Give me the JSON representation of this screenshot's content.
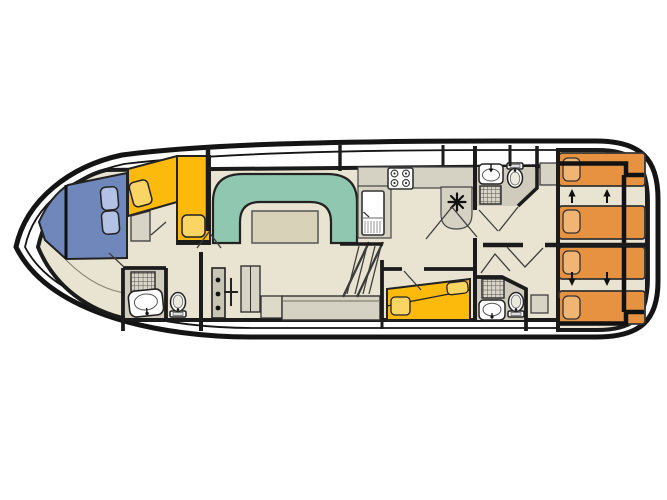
{
  "meta": {
    "type": "boat-deck-plan",
    "description": "Top-down interior floor plan of a canal houseboat, bow pointing left",
    "visible_text": []
  },
  "palette": {
    "hull": "#141414",
    "wall": "#1b1b1b",
    "floor": "#e9e4d2",
    "deck": "#ffffff",
    "bath_floor": "#cfcbbd",
    "counter": "#d5d1c3",
    "furn": "#d7d3c5",
    "sofa_teal": "#90c7b1",
    "table_tan": "#d8d2b8",
    "berth_yellow": "#fbba0c",
    "cushion_yellow": "#fad564",
    "bed_orange": "#e79240",
    "pillow_orange": "#f0b573",
    "bow_blue": "#7087bc",
    "cushion_blue": "#b2c1e4",
    "fixture": "#ffffff",
    "swing": "#3c3c3c",
    "outline": "#333333"
  },
  "rooms": [
    {
      "name": "bow-cabin",
      "furniture": [
        "blue-v-berth",
        "two-blue-cushions",
        "yellow-l-berth",
        "two-yellow-cushions",
        "step-unit"
      ]
    },
    {
      "name": "bow-bathroom",
      "furniture": [
        "shower",
        "washbasin",
        "toilet"
      ]
    },
    {
      "name": "saloon",
      "furniture": [
        "u-shaped-sofa",
        "dinette-table",
        "wardrobe",
        "sideboard",
        "bench-counter",
        "entry-steps"
      ]
    },
    {
      "name": "galley",
      "furniture": [
        "four-burner-stove",
        "fridge",
        "counter-peninsula",
        "heater"
      ]
    },
    {
      "name": "mid-bathroom-top",
      "furniture": [
        "washbasin",
        "toilet",
        "shower"
      ]
    },
    {
      "name": "mid-cabin-double",
      "furniture": [
        "yellow-double-bed",
        "two-pillows"
      ]
    },
    {
      "name": "mid-bathroom-bottom",
      "furniture": [
        "shower",
        "washbasin",
        "toilet"
      ]
    },
    {
      "name": "aft-cabin-top",
      "furniture": [
        "single-bed",
        "single-bed",
        "slide-arrows-up",
        "nightstand",
        "slide-frame"
      ]
    },
    {
      "name": "aft-cabin-bottom",
      "furniture": [
        "single-bed",
        "single-bed",
        "slide-arrows-down",
        "nightstand",
        "slide-frame"
      ]
    }
  ],
  "counts": {
    "aft_single_beds": 4,
    "double_beds": 1,
    "bow_berths": 2,
    "bathrooms": 3,
    "showers": 3,
    "toilets": 3,
    "basins": 3,
    "slide_arrows": 4
  }
}
